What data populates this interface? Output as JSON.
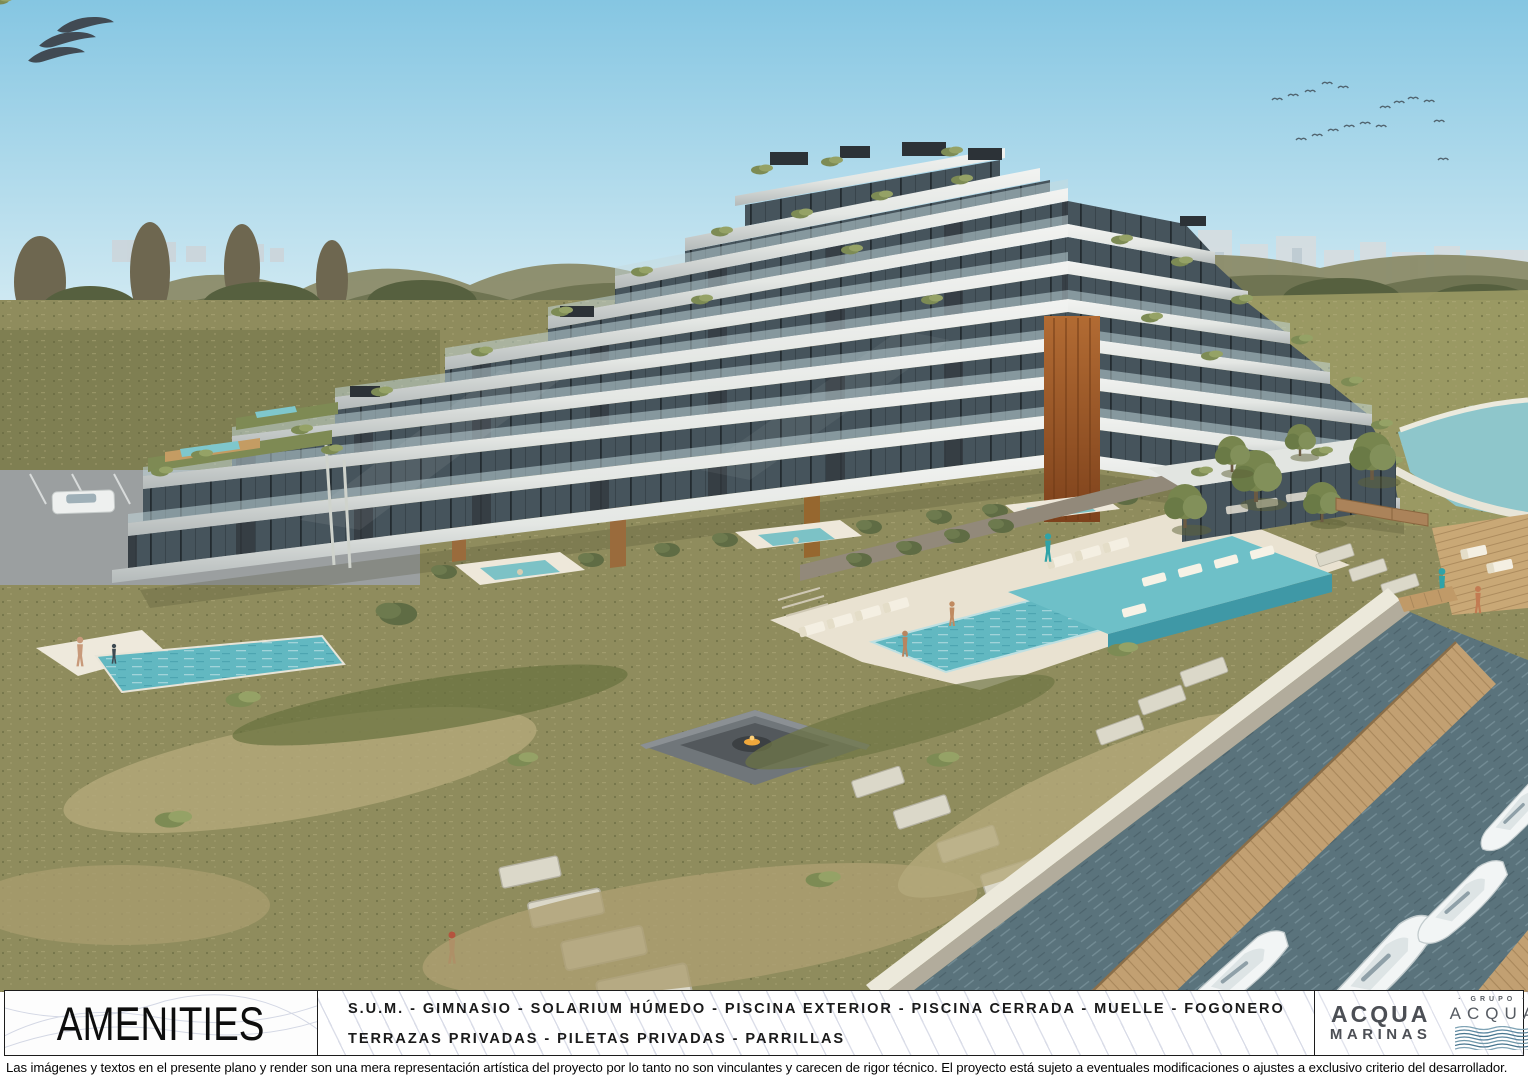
{
  "watermark": {
    "logo": "triple-wave"
  },
  "colors": {
    "sky_top": "#85c6e2",
    "sky_horizon": "#d8edf4",
    "lawn": "#8f8c5d",
    "tall_grass": "#b4a97b",
    "pool_water": "#62b8c1",
    "canal_water": "#5a737c",
    "corten_accent": "#a55e2b",
    "slab_concrete": "#e8eae7",
    "dock_wood": "#c2a072",
    "logo_dark": "#3b4047"
  },
  "footer": {
    "title": "AMENITIES",
    "amenities": [
      "S.U.M. - GIMNASIO - SOLARIUM HÚMEDO - PISCINA EXTERIOR - PISCINA CERRADA - MUELLE - FOGONERO",
      "TERRAZAS PRIVADAS - PILETAS PRIVADAS - PARRILLAS"
    ],
    "logos": {
      "acqua_marinas_line1": "ACQUA",
      "acqua_marinas_line2": "MARINAS",
      "grupo_label": "· GRUPO ·",
      "grupo_name": "ACQUA",
      "esp_name": "ESP",
      "esp_sub": "ARQUITECTURA"
    }
  },
  "disclaimer": "Las imágenes y textos en el presente plano y render son una mera representación artística del proyecto por lo tanto no son vinculantes y carecen de rigor técnico. El proyecto está sujeto a eventuales modificaciones o ajustes a exclusivo criterio del desarrollador."
}
